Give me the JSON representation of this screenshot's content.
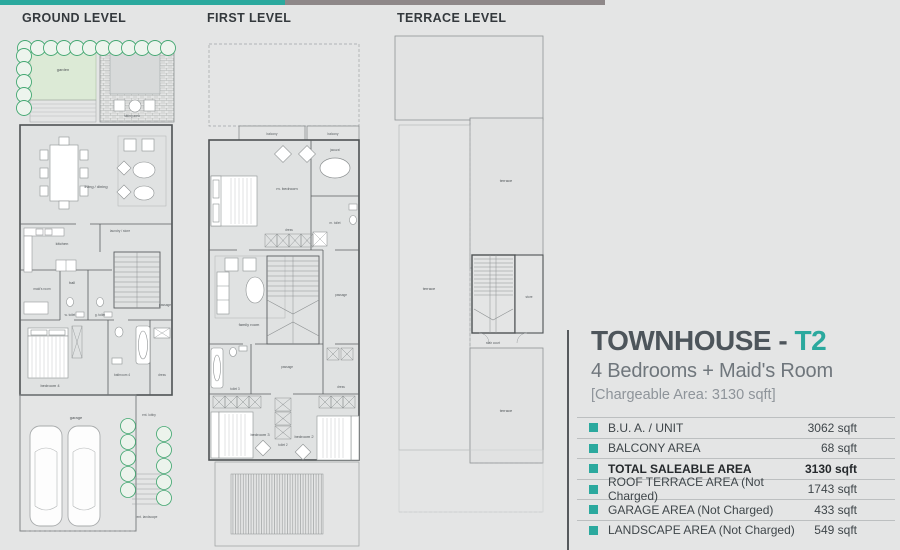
{
  "plans": {
    "ground": {
      "label": "GROUND LEVEL",
      "rooms": {
        "garden": "garden",
        "sitting": "sitting area",
        "living": "living / dining",
        "kitchen": "kitchen",
        "laundry": "laundry / store",
        "hall": "hall",
        "maid": "maid's room",
        "wtoilet": "w. toilet",
        "gtoilet": "g. toilet",
        "passage": "passage",
        "bedroom4": "bedroom 4",
        "bathroom4": "bathroom 4",
        "dress": "dress",
        "garage": "garage",
        "lobby": "ent. lobby",
        "landscape": "ent. landscape"
      }
    },
    "first": {
      "label": "FIRST LEVEL",
      "rooms": {
        "balcony1": "balcony",
        "balcony2": "balcony",
        "jacuzzi": "jacuzzi",
        "mbedroom": "m. bedroom",
        "mtoilet": "m. toilet",
        "dress1": "dress",
        "family": "family room",
        "passage1": "passage",
        "passage2": "passage",
        "toilet3": "toilet 3",
        "toilet2": "toilet 2",
        "dress2": "dress",
        "bedroom3": "bedroom 3",
        "bedroom2": "bedroom 2"
      }
    },
    "terrace": {
      "label": "TERRACE LEVEL",
      "rooms": {
        "terrace1": "terrace",
        "terrace2": "terrace",
        "store": "store",
        "staircourt": "stair court",
        "terrace3": "terrace"
      }
    }
  },
  "info": {
    "title": "TOWNHOUSE - ",
    "title_accent": "T2",
    "subtitle": "4 Bedrooms + Maid's Room",
    "chargeable": "[Chargeable Area: 3130 sqft]",
    "accent_color": "#2ba99e",
    "rows": [
      {
        "label": "B.U. A. / UNIT",
        "value": "3062 sqft",
        "bold": false
      },
      {
        "label": "BALCONY AREA",
        "value": "68 sqft",
        "bold": false
      },
      {
        "label": "TOTAL SALEABLE AREA",
        "value": "3130 sqft",
        "bold": true
      },
      {
        "label": "ROOF TERRACE AREA (Not Charged)",
        "value": "1743 sqft",
        "bold": false
      },
      {
        "label": "GARAGE AREA (Not Charged)",
        "value": "433 sqft",
        "bold": false
      },
      {
        "label": "LANDSCAPE AREA (Not Charged)",
        "value": "549 sqft",
        "bold": false
      }
    ]
  }
}
